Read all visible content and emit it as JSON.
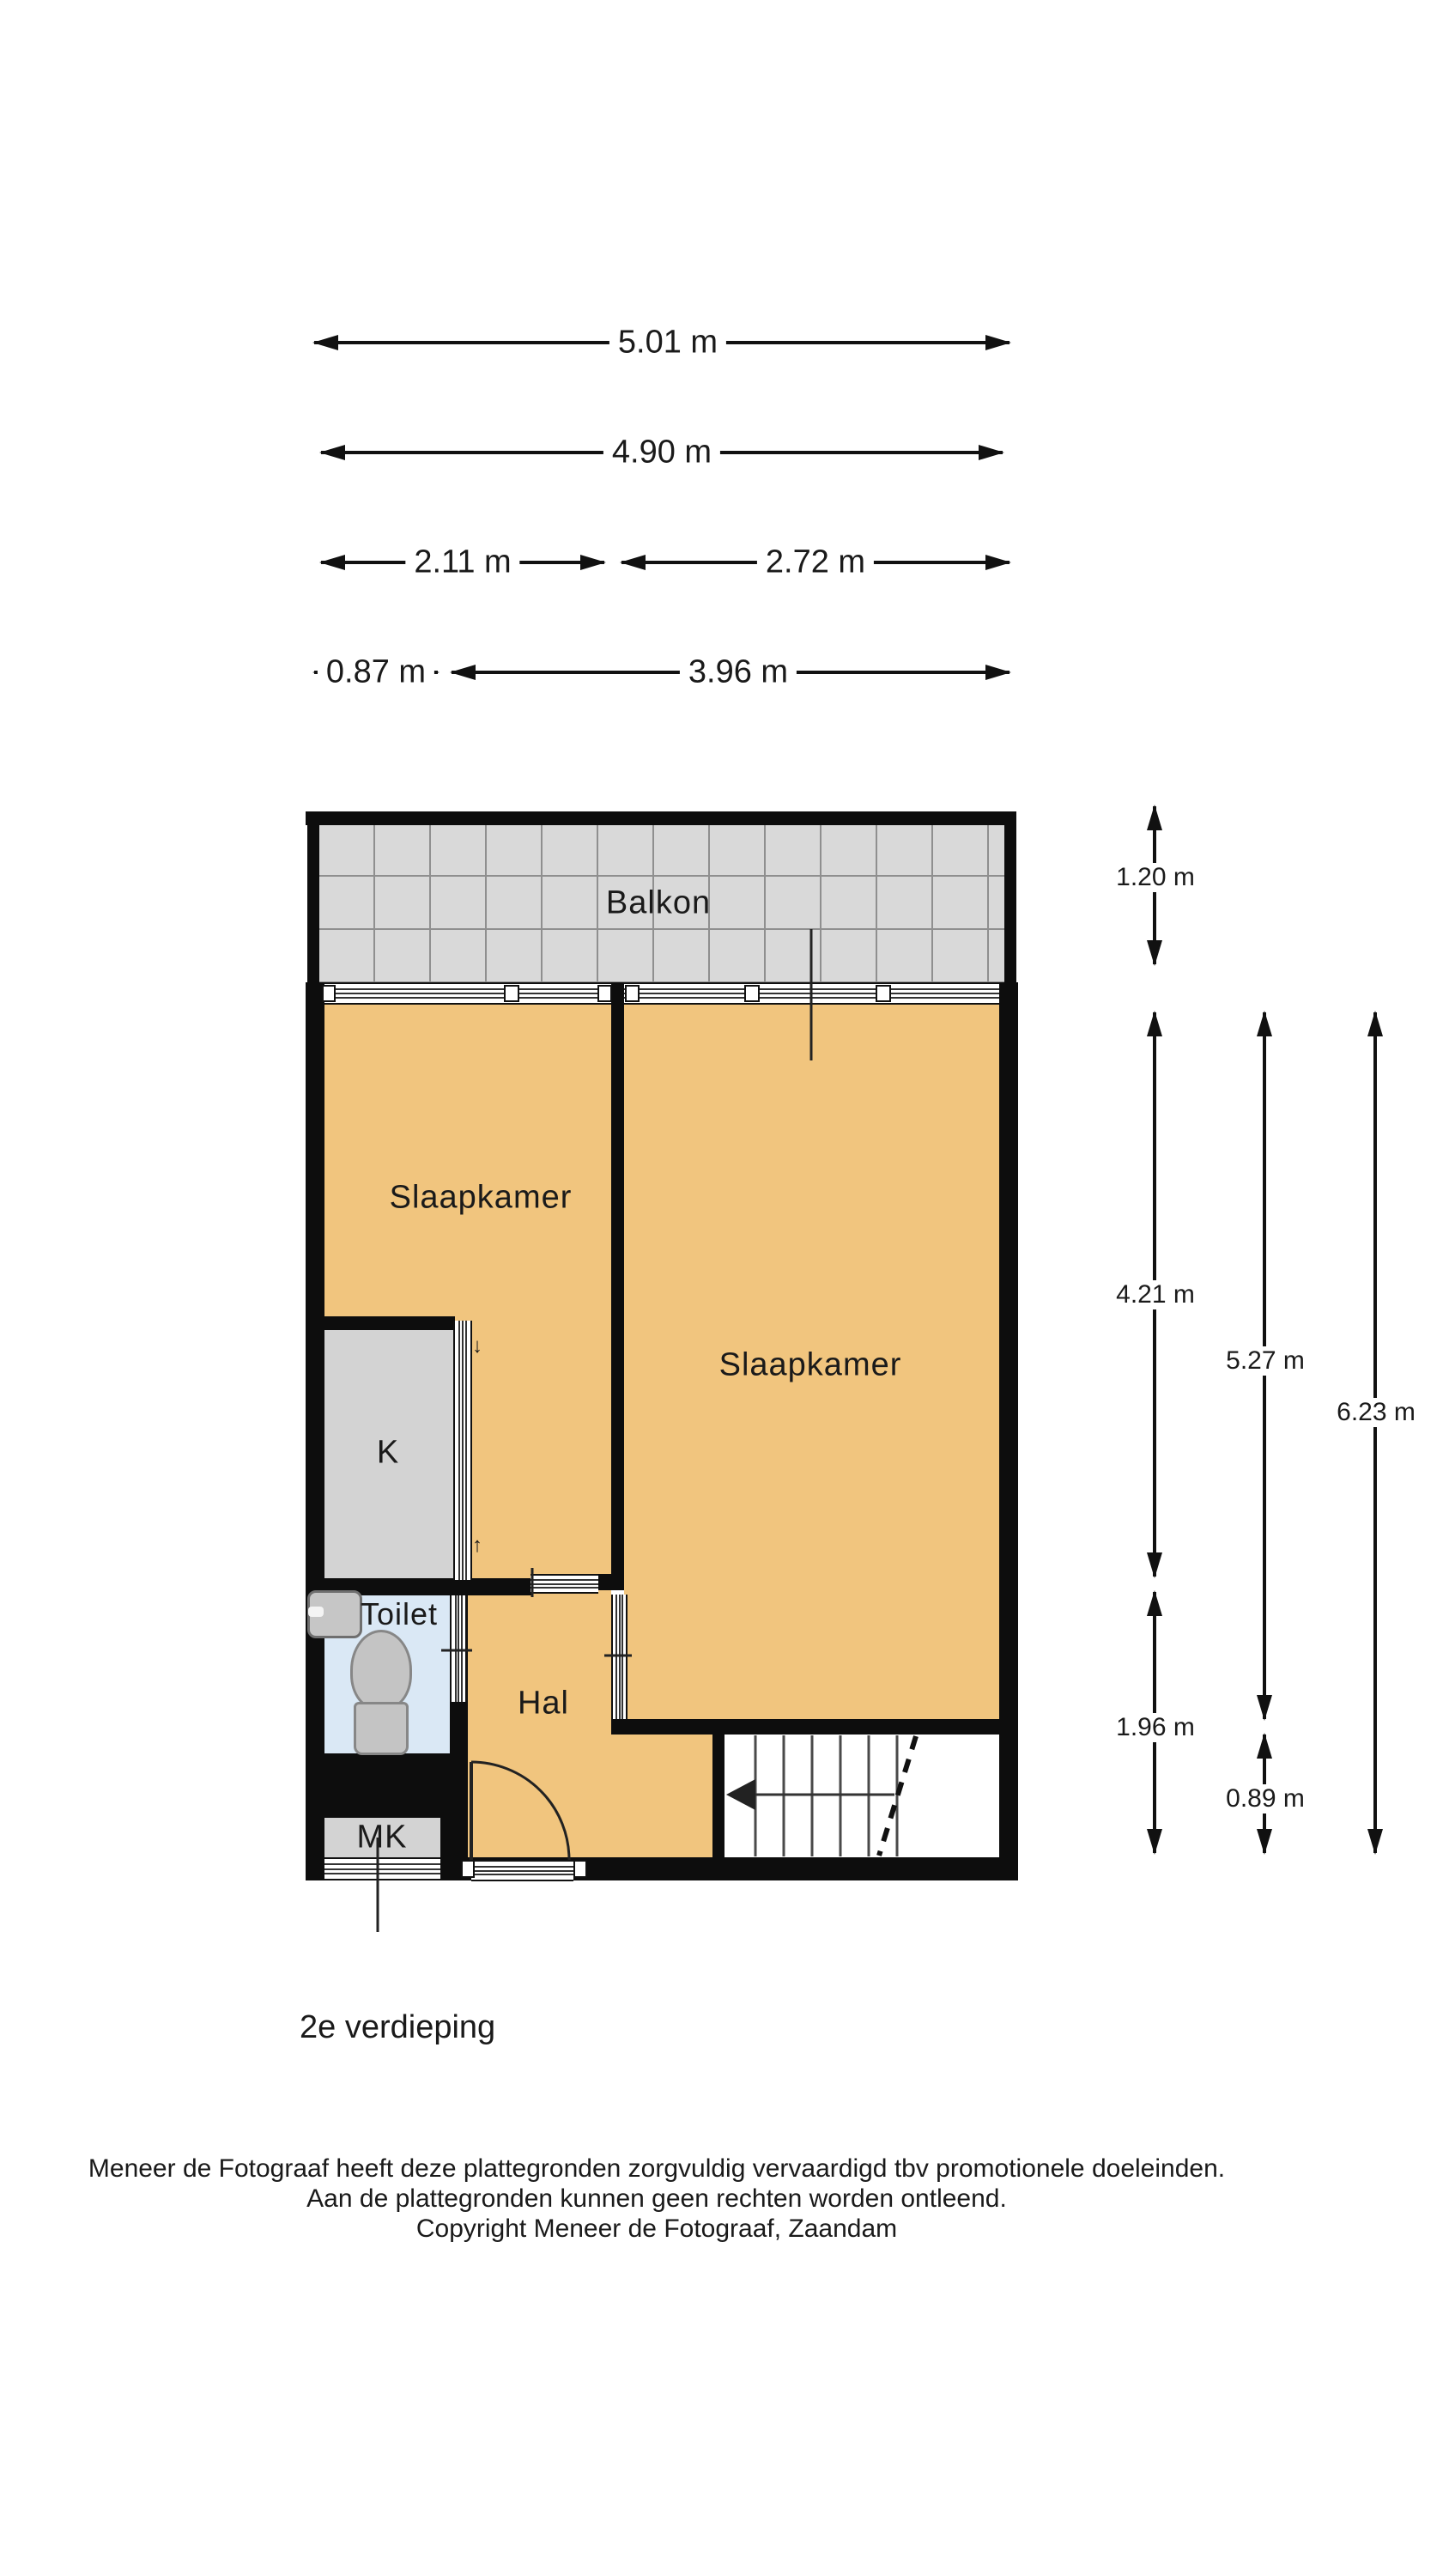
{
  "floor_title": "2e verdieping",
  "rooms": {
    "balkon": "Balkon",
    "slaapkamer_left": "Slaapkamer",
    "slaapkamer_right": "Slaapkamer",
    "kast": "K",
    "toilet": "Toilet",
    "hal": "Hal",
    "meterkast": "MK"
  },
  "dimensions": {
    "top": [
      "5.01 m",
      "4.90 m",
      "2.11 m",
      "2.72 m",
      "0.87 m",
      "3.96 m"
    ],
    "right": [
      "1.20 m",
      "4.21 m",
      "1.96 m",
      "5.27 m",
      "0.89 m",
      "6.23 m"
    ]
  },
  "door_swing_marks": {
    "down": "↓",
    "up": "↑"
  },
  "footer": {
    "line1": "Meneer de Fotograaf heeft deze plattegronden zorgvuldig vervaardigd tbv promotionele doeleinden.",
    "line2": "Aan de plattegronden kunnen geen rechten worden ontleend.",
    "line3": "Copyright Meneer de Fotograaf, Zaandam"
  },
  "colors": {
    "wall": "#0d0d0d",
    "room_floor": "#f1c57e",
    "balcony_floor": "#d9d9d9",
    "service_floor": "#d3d3d3",
    "toilet_floor": "#dae8f5",
    "text": "#1a1a1a"
  }
}
